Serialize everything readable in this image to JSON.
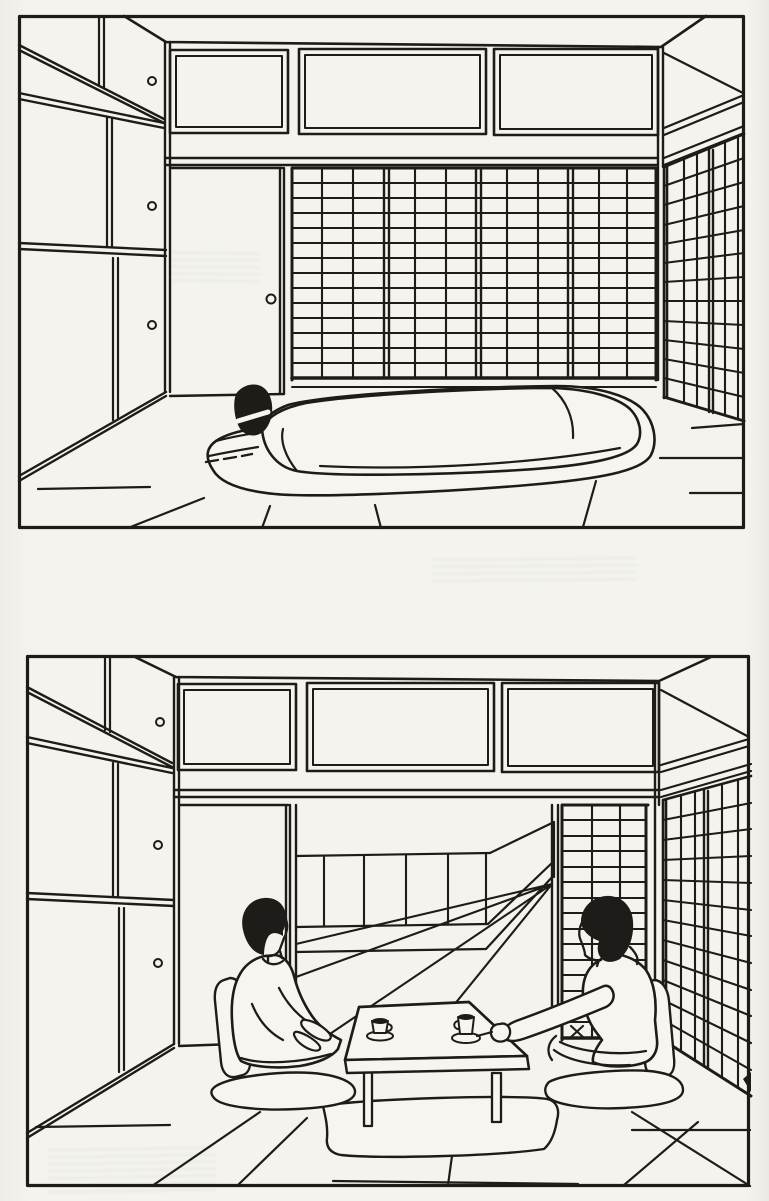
{
  "document": {
    "kind": "Scanned black-and-white line illustration page with two panels of the same Japanese tatami room",
    "page_color": "#f4f3ee",
    "ink_color": "#1e1c19",
    "panel_count": 2,
    "visible_text": "none"
  },
  "panels": {
    "night": {
      "alt": "Japanese tatami room prepared for sleeping: a futon with a quilt and a dark pillow laid out on the tatami floor; four closed shoji screens and a sliding door on the back wall, three transom panels above, a closet with sliding doors and round pulls on the left wall, and another shoji screen wall on the right.",
      "elements": {
        "futon": 1,
        "quilt": 1,
        "pillow": 1,
        "shoji_panels_back_wall": 4,
        "shoji_panels_right_wall": 2,
        "transom_panels": 3,
        "closet_door_pulls": 3,
        "sliding_door": 1
      }
    },
    "day": {
      "alt": "The same tatami room during the day: the futon is put away and the shoji screens are slid open toward an adjacent room with a low window wall; two people sit facing each other on legless floor chairs with cushions at a low table holding two tea cups, over a small rug.",
      "elements": {
        "people": 2,
        "tea_cups": 2,
        "low_table": 1,
        "table_legs_visible": 2,
        "rug": 1,
        "floor_chairs": 2,
        "floor_cushions": 2,
        "shoji_panels_right_wall": 2,
        "transom_panels": 3,
        "closet_door_pulls": 3
      }
    }
  }
}
